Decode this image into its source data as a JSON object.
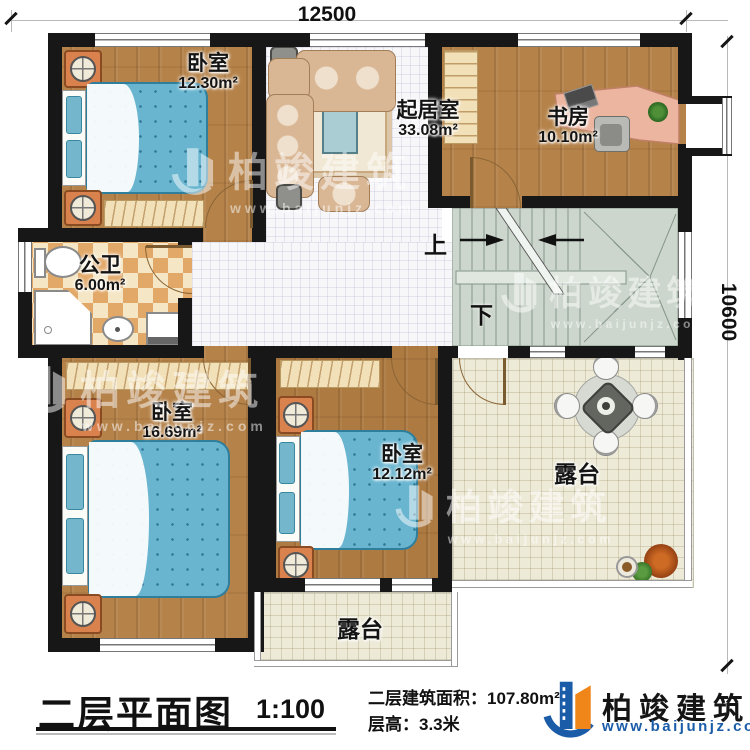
{
  "dimensions": {
    "width_label": "12500",
    "height_label": "10600"
  },
  "rooms": {
    "bedroom_tl": {
      "name": "卧室",
      "area": "12.30m²"
    },
    "living": {
      "name": "起居室",
      "area": "33.08m²"
    },
    "study": {
      "name": "书房",
      "area": "10.10m²"
    },
    "bathroom": {
      "name": "公卫",
      "area": "6.00m²"
    },
    "bedroom_bl": {
      "name": "卧室",
      "area": "16.69m²"
    },
    "bedroom_bm": {
      "name": "卧室",
      "area": "12.12m²"
    },
    "terrace_right": {
      "name": "露台"
    },
    "terrace_bottom": {
      "name": "露台"
    }
  },
  "stairs": {
    "up_label": "上",
    "down_label": "下"
  },
  "title_block": {
    "title": "二层平面图",
    "scale": "1:100",
    "area_label": "二层建筑面积：",
    "area_value": "107.80m²",
    "floor_height_label": "层高：3.3米"
  },
  "brand": {
    "name": "柏竣建筑",
    "url": "www.baijunjz.com"
  },
  "watermark": {
    "name": "柏竣建筑",
    "url": "www.baijunjz.com"
  },
  "colors": {
    "wall": "#171717",
    "wood_floor": "#b5834a",
    "bed_blue": "#69b5d0",
    "brand_blue": "#1a5ca8",
    "brand_orange": "#f08519",
    "stair_green": "#ccd6cc"
  }
}
